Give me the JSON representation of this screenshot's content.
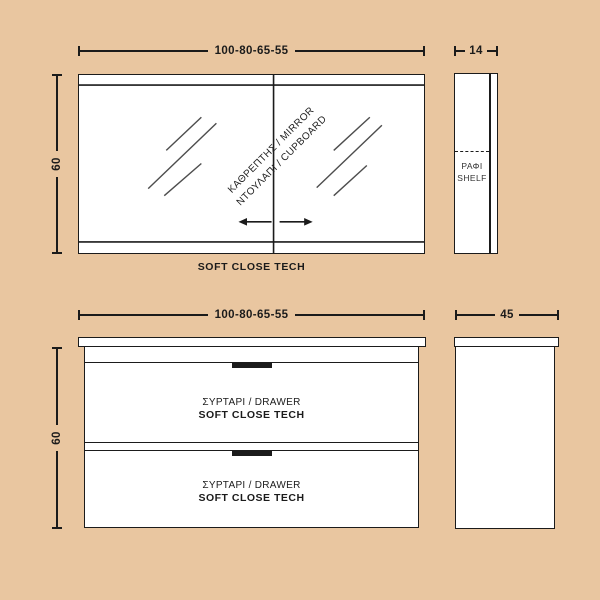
{
  "colors": {
    "background": "#e9c6a0",
    "line": "#1b1b1b",
    "fill": "#ffffff",
    "shine_line": "#4d4d4d"
  },
  "top": {
    "front": {
      "width_dim": "100-80-65-55",
      "height_dim": "60",
      "mirror_label_line1": "ΚΑΘΡΕΠΤΗΣ / MIRROR",
      "mirror_label_line2": "ΝΤΟΥΛΑΠΙ / CUPBOARD",
      "caption": "SOFT CLOSE TECH"
    },
    "side": {
      "depth_dim": "14",
      "shelf_gr": "ΡΑΦΙ",
      "shelf_en": "SHELF"
    }
  },
  "bottom": {
    "front": {
      "width_dim": "100-80-65-55",
      "height_dim": "60",
      "drawers": [
        {
          "line1": "ΣΥΡΤΑΡΙ / DRAWER",
          "line2": "SOFT CLOSE TECH"
        },
        {
          "line1": "ΣΥΡΤΑΡΙ / DRAWER",
          "line2": "SOFT CLOSE TECH"
        }
      ]
    },
    "side": {
      "depth_dim": "45"
    }
  }
}
